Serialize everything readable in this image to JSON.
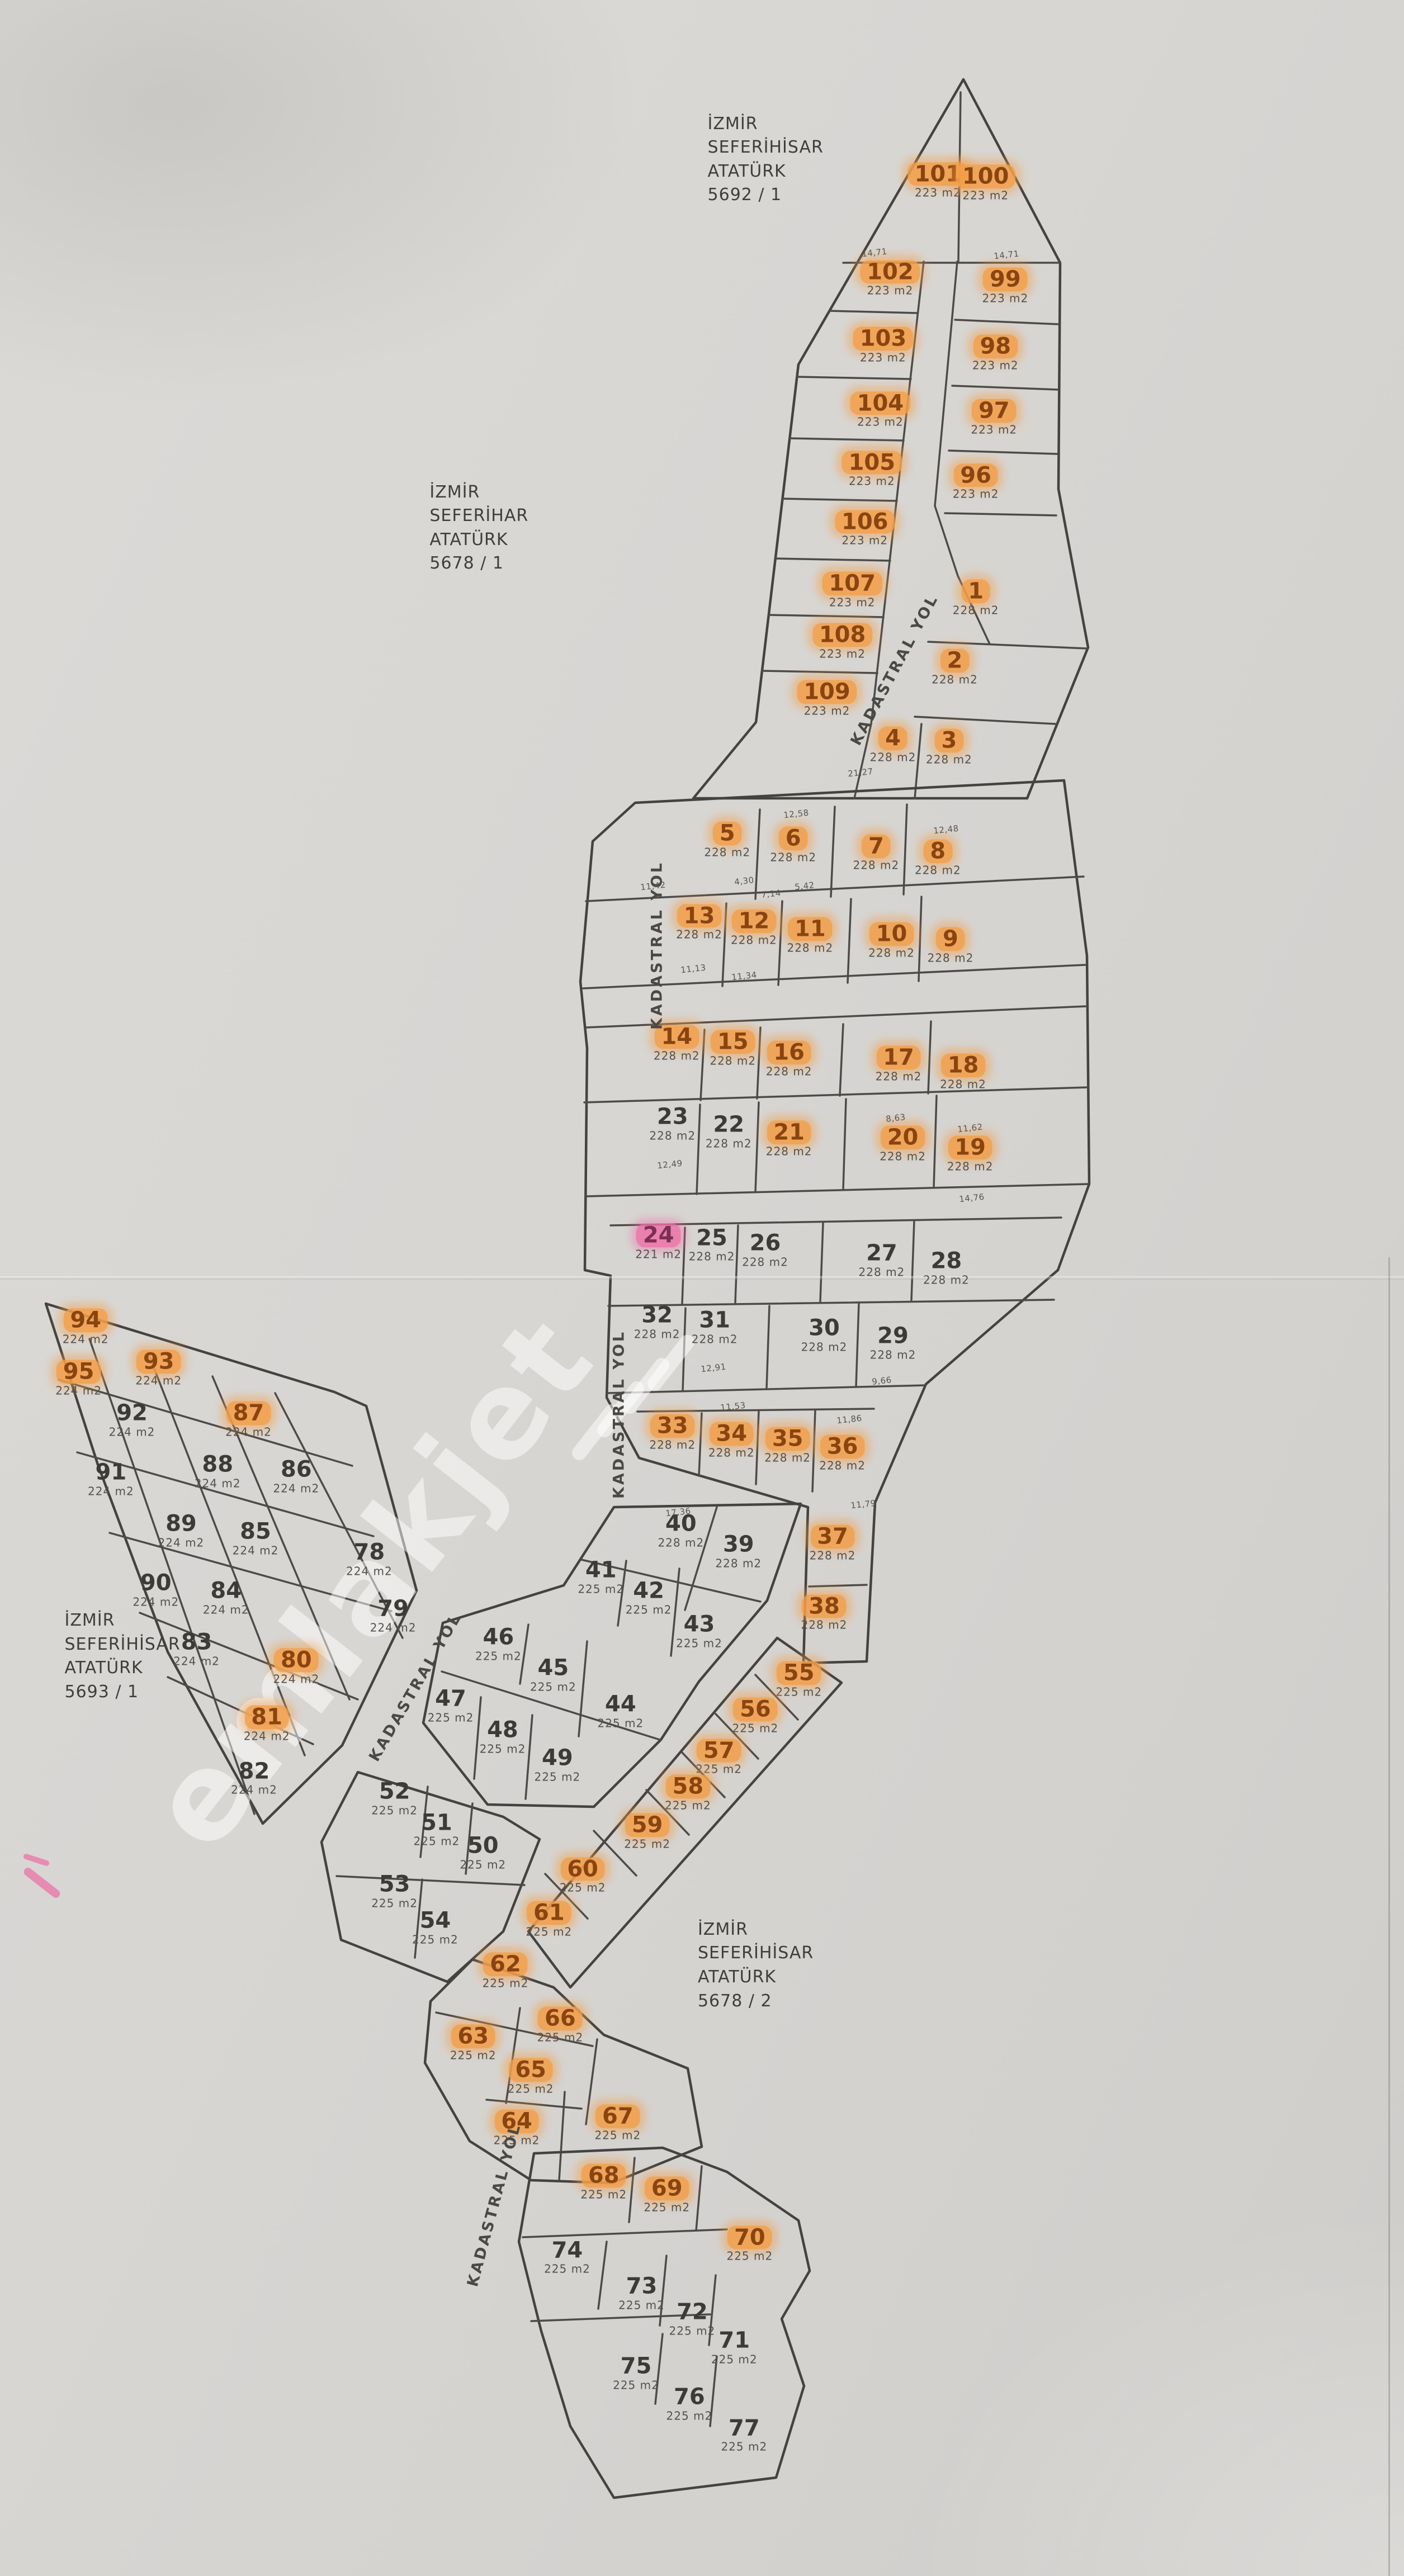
{
  "map": {
    "watermark": {
      "text": "emlakjet"
    },
    "palette": {
      "paper": "#d8d6d3",
      "line": "#454340",
      "highlight_orange": "#f29e48",
      "highlight_pink": "#ee6ca6",
      "number": "#3d3b37",
      "number_hl": "#8a4410",
      "area_text": "#53514c"
    },
    "region_labels": [
      {
        "name": "block-5692-1",
        "text": "İZMİR\nSEFERİHİSAR\nATATÜRK\n5692 / 1",
        "x": 50.4,
        "y": 6.2
      },
      {
        "name": "block-5678-1",
        "text": "İZMİR\nSEFERİHAR\nATATÜRK\n5678 / 1",
        "x": 30.6,
        "y": 20.5
      },
      {
        "name": "block-5693-1",
        "text": "İZMİR\nSEFERİHİSAR\nATATÜRK\n5693 / 1",
        "x": 4.6,
        "y": 64.3
      },
      {
        "name": "block-5678-2",
        "text": "İZMİR\nSEFERİHİSAR\nATATÜRK\n5678 / 2",
        "x": 49.7,
        "y": 76.3
      }
    ],
    "road_labels": [
      {
        "text": "KADASTRAL YOL",
        "x": 63.7,
        "y": 26.0,
        "rot": -62
      },
      {
        "text": "KADASTRAL YOL",
        "x": 46.8,
        "y": 36.7,
        "rot": -90
      },
      {
        "text": "KADASTRAL YOL",
        "x": 44.1,
        "y": 54.9,
        "rot": -90
      },
      {
        "text": "KADASTRAL YOL",
        "x": 29.6,
        "y": 65.5,
        "rot": -60
      },
      {
        "text": "KADASTRAL YOL",
        "x": 35.2,
        "y": 85.6,
        "rot": -75
      }
    ],
    "parcels": [
      {
        "n": "101",
        "a": "223 m2",
        "x": 66.8,
        "y": 7.0,
        "h": "o"
      },
      {
        "n": "100",
        "a": "223 m2",
        "x": 70.2,
        "y": 7.1,
        "h": "o"
      },
      {
        "n": "102",
        "a": "223 m2",
        "x": 63.4,
        "y": 10.8,
        "h": "o"
      },
      {
        "n": "99",
        "a": "223 m2",
        "x": 71.6,
        "y": 11.1,
        "h": "o"
      },
      {
        "n": "103",
        "a": "223 m2",
        "x": 62.9,
        "y": 13.4,
        "h": "o"
      },
      {
        "n": "98",
        "a": "223 m2",
        "x": 70.9,
        "y": 13.7,
        "h": "o"
      },
      {
        "n": "104",
        "a": "223 m2",
        "x": 62.7,
        "y": 15.9,
        "h": "o"
      },
      {
        "n": "97",
        "a": "223 m2",
        "x": 70.8,
        "y": 16.2,
        "h": "o"
      },
      {
        "n": "105",
        "a": "223 m2",
        "x": 62.1,
        "y": 18.2,
        "h": "o"
      },
      {
        "n": "96",
        "a": "223 m2",
        "x": 69.5,
        "y": 18.7,
        "h": "o"
      },
      {
        "n": "106",
        "a": "223 m2",
        "x": 61.6,
        "y": 20.5,
        "h": "o"
      },
      {
        "n": "107",
        "a": "223 m2",
        "x": 60.7,
        "y": 22.9,
        "h": "o"
      },
      {
        "n": "108",
        "a": "223 m2",
        "x": 60.0,
        "y": 24.9,
        "h": "o"
      },
      {
        "n": "109",
        "a": "223 m2",
        "x": 58.9,
        "y": 27.1,
        "h": "o"
      },
      {
        "n": "1",
        "a": "228 m2",
        "x": 69.5,
        "y": 23.2,
        "h": "o"
      },
      {
        "n": "2",
        "a": "228 m2",
        "x": 68.0,
        "y": 25.9,
        "h": "o"
      },
      {
        "n": "3",
        "a": "228 m2",
        "x": 67.6,
        "y": 29.0,
        "h": "o"
      },
      {
        "n": "4",
        "a": "228 m2",
        "x": 63.6,
        "y": 28.9,
        "h": "o"
      },
      {
        "n": "5",
        "a": "228 m2",
        "x": 51.8,
        "y": 32.6,
        "h": "o"
      },
      {
        "n": "6",
        "a": "228 m2",
        "x": 56.5,
        "y": 32.8,
        "h": "o"
      },
      {
        "n": "7",
        "a": "228 m2",
        "x": 62.4,
        "y": 33.1,
        "h": "o"
      },
      {
        "n": "8",
        "a": "228 m2",
        "x": 66.8,
        "y": 33.3,
        "h": "o"
      },
      {
        "n": "9",
        "a": "228 m2",
        "x": 67.7,
        "y": 36.7,
        "h": "o"
      },
      {
        "n": "10",
        "a": "228 m2",
        "x": 63.5,
        "y": 36.5,
        "h": "o"
      },
      {
        "n": "11",
        "a": "228 m2",
        "x": 57.7,
        "y": 36.3,
        "h": "o"
      },
      {
        "n": "12",
        "a": "228 m2",
        "x": 53.7,
        "y": 36.0,
        "h": "o"
      },
      {
        "n": "13",
        "a": "228 m2",
        "x": 49.8,
        "y": 35.8,
        "h": "o"
      },
      {
        "n": "14",
        "a": "228 m2",
        "x": 48.2,
        "y": 40.5,
        "h": "o"
      },
      {
        "n": "15",
        "a": "228 m2",
        "x": 52.2,
        "y": 40.7,
        "h": "o"
      },
      {
        "n": "16",
        "a": "228 m2",
        "x": 56.2,
        "y": 41.1,
        "h": "o"
      },
      {
        "n": "17",
        "a": "228 m2",
        "x": 64.0,
        "y": 41.3,
        "h": "o"
      },
      {
        "n": "18",
        "a": "228 m2",
        "x": 68.6,
        "y": 41.6,
        "h": "o"
      },
      {
        "n": "19",
        "a": "228 m2",
        "x": 69.1,
        "y": 44.8,
        "h": "o"
      },
      {
        "n": "20",
        "a": "228 m2",
        "x": 64.3,
        "y": 44.4,
        "h": "o"
      },
      {
        "n": "21",
        "a": "228 m2",
        "x": 56.2,
        "y": 44.2,
        "h": "o"
      },
      {
        "n": "22",
        "a": "228 m2",
        "x": 51.9,
        "y": 43.9,
        "h": ""
      },
      {
        "n": "23",
        "a": "228 m2",
        "x": 47.9,
        "y": 43.6,
        "h": ""
      },
      {
        "n": "24",
        "a": "221 m2",
        "x": 46.9,
        "y": 48.2,
        "h": "p"
      },
      {
        "n": "25",
        "a": "228 m2",
        "x": 50.7,
        "y": 48.3,
        "h": ""
      },
      {
        "n": "26",
        "a": "228 m2",
        "x": 54.5,
        "y": 48.5,
        "h": ""
      },
      {
        "n": "27",
        "a": "228 m2",
        "x": 62.8,
        "y": 48.9,
        "h": ""
      },
      {
        "n": "28",
        "a": "228 m2",
        "x": 67.4,
        "y": 49.2,
        "h": ""
      },
      {
        "n": "29",
        "a": "228 m2",
        "x": 63.6,
        "y": 52.1,
        "h": ""
      },
      {
        "n": "30",
        "a": "228 m2",
        "x": 58.7,
        "y": 51.8,
        "h": ""
      },
      {
        "n": "31",
        "a": "228 m2",
        "x": 50.9,
        "y": 51.5,
        "h": ""
      },
      {
        "n": "32",
        "a": "228 m2",
        "x": 46.8,
        "y": 51.3,
        "h": ""
      },
      {
        "n": "33",
        "a": "228 m2",
        "x": 47.9,
        "y": 55.6,
        "h": "o"
      },
      {
        "n": "34",
        "a": "228 m2",
        "x": 52.1,
        "y": 55.9,
        "h": "o"
      },
      {
        "n": "35",
        "a": "228 m2",
        "x": 56.1,
        "y": 56.1,
        "h": "o"
      },
      {
        "n": "36",
        "a": "228 m2",
        "x": 60.0,
        "y": 56.4,
        "h": "o"
      },
      {
        "n": "37",
        "a": "228 m2",
        "x": 59.3,
        "y": 59.9,
        "h": "o"
      },
      {
        "n": "38",
        "a": "228 m2",
        "x": 58.7,
        "y": 62.6,
        "h": "o"
      },
      {
        "n": "39",
        "a": "228 m2",
        "x": 52.6,
        "y": 60.2,
        "h": ""
      },
      {
        "n": "40",
        "a": "228 m2",
        "x": 48.5,
        "y": 59.4,
        "h": ""
      },
      {
        "n": "41",
        "a": "225 m2",
        "x": 42.8,
        "y": 61.2,
        "h": ""
      },
      {
        "n": "42",
        "a": "225 m2",
        "x": 46.2,
        "y": 62.0,
        "h": ""
      },
      {
        "n": "43",
        "a": "225 m2",
        "x": 49.8,
        "y": 63.3,
        "h": ""
      },
      {
        "n": "44",
        "a": "225 m2",
        "x": 44.2,
        "y": 66.4,
        "h": ""
      },
      {
        "n": "45",
        "a": "225 m2",
        "x": 39.4,
        "y": 65.0,
        "h": ""
      },
      {
        "n": "46",
        "a": "225 m2",
        "x": 35.5,
        "y": 63.8,
        "h": ""
      },
      {
        "n": "47",
        "a": "225 m2",
        "x": 32.1,
        "y": 66.2,
        "h": ""
      },
      {
        "n": "48",
        "a": "225 m2",
        "x": 35.8,
        "y": 67.4,
        "h": ""
      },
      {
        "n": "49",
        "a": "225 m2",
        "x": 39.7,
        "y": 68.5,
        "h": ""
      },
      {
        "n": "50",
        "a": "225 m2",
        "x": 34.4,
        "y": 71.9,
        "h": ""
      },
      {
        "n": "51",
        "a": "225 m2",
        "x": 31.1,
        "y": 71.0,
        "h": ""
      },
      {
        "n": "52",
        "a": "225 m2",
        "x": 28.1,
        "y": 69.8,
        "h": ""
      },
      {
        "n": "53",
        "a": "225 m2",
        "x": 28.1,
        "y": 73.4,
        "h": ""
      },
      {
        "n": "54",
        "a": "225 m2",
        "x": 31.0,
        "y": 74.8,
        "h": ""
      },
      {
        "n": "55",
        "a": "225 m2",
        "x": 56.9,
        "y": 65.2,
        "h": "o"
      },
      {
        "n": "56",
        "a": "225 m2",
        "x": 53.8,
        "y": 66.6,
        "h": "o"
      },
      {
        "n": "57",
        "a": "225 m2",
        "x": 51.2,
        "y": 68.2,
        "h": "o"
      },
      {
        "n": "58",
        "a": "225 m2",
        "x": 49.0,
        "y": 69.6,
        "h": "o"
      },
      {
        "n": "59",
        "a": "225 m2",
        "x": 46.1,
        "y": 71.1,
        "h": "o"
      },
      {
        "n": "60",
        "a": "225 m2",
        "x": 41.5,
        "y": 72.8,
        "h": "o"
      },
      {
        "n": "61",
        "a": "225 m2",
        "x": 39.1,
        "y": 74.5,
        "h": "o"
      },
      {
        "n": "62",
        "a": "225 m2",
        "x": 36.0,
        "y": 76.5,
        "h": "o"
      },
      {
        "n": "63",
        "a": "225 m2",
        "x": 33.7,
        "y": 79.3,
        "h": "o"
      },
      {
        "n": "64",
        "a": "225 m2",
        "x": 36.8,
        "y": 82.6,
        "h": "o"
      },
      {
        "n": "65",
        "a": "225 m2",
        "x": 37.8,
        "y": 80.6,
        "h": "o"
      },
      {
        "n": "66",
        "a": "225 m2",
        "x": 39.9,
        "y": 78.6,
        "h": "o"
      },
      {
        "n": "67",
        "a": "225 m2",
        "x": 44.0,
        "y": 82.4,
        "h": "o"
      },
      {
        "n": "68",
        "a": "225 m2",
        "x": 43.0,
        "y": 84.7,
        "h": "o"
      },
      {
        "n": "69",
        "a": "225 m2",
        "x": 47.5,
        "y": 85.2,
        "h": "o"
      },
      {
        "n": "70",
        "a": "225 m2",
        "x": 53.4,
        "y": 87.1,
        "h": "o"
      },
      {
        "n": "71",
        "a": "225 m2",
        "x": 52.3,
        "y": 91.1,
        "h": ""
      },
      {
        "n": "72",
        "a": "225 m2",
        "x": 49.3,
        "y": 90.0,
        "h": ""
      },
      {
        "n": "73",
        "a": "225 m2",
        "x": 45.7,
        "y": 89.0,
        "h": ""
      },
      {
        "n": "74",
        "a": "225 m2",
        "x": 40.4,
        "y": 87.6,
        "h": ""
      },
      {
        "n": "75",
        "a": "225 m2",
        "x": 45.3,
        "y": 92.1,
        "h": ""
      },
      {
        "n": "76",
        "a": "225 m2",
        "x": 49.1,
        "y": 93.3,
        "h": ""
      },
      {
        "n": "77",
        "a": "225 m2",
        "x": 53.0,
        "y": 94.5,
        "h": ""
      },
      {
        "n": "78",
        "a": "224 m2",
        "x": 26.3,
        "y": 60.5,
        "h": ""
      },
      {
        "n": "79",
        "a": "224 m2",
        "x": 28.0,
        "y": 62.7,
        "h": ""
      },
      {
        "n": "80",
        "a": "224 m2",
        "x": 21.1,
        "y": 64.7,
        "h": "o"
      },
      {
        "n": "81",
        "a": "224 m2",
        "x": 19.0,
        "y": 66.9,
        "h": "o"
      },
      {
        "n": "82",
        "a": "224 m2",
        "x": 18.1,
        "y": 69.0,
        "h": ""
      },
      {
        "n": "83",
        "a": "224 m2",
        "x": 14.0,
        "y": 64.0,
        "h": ""
      },
      {
        "n": "84",
        "a": "224 m2",
        "x": 16.1,
        "y": 62.0,
        "h": ""
      },
      {
        "n": "85",
        "a": "224 m2",
        "x": 18.2,
        "y": 59.7,
        "h": ""
      },
      {
        "n": "86",
        "a": "224 m2",
        "x": 21.1,
        "y": 57.3,
        "h": ""
      },
      {
        "n": "87",
        "a": "224 m2",
        "x": 17.7,
        "y": 55.1,
        "h": "o"
      },
      {
        "n": "88",
        "a": "224 m2",
        "x": 15.5,
        "y": 57.1,
        "h": ""
      },
      {
        "n": "89",
        "a": "224 m2",
        "x": 12.9,
        "y": 59.4,
        "h": ""
      },
      {
        "n": "90",
        "a": "224 m2",
        "x": 11.1,
        "y": 61.7,
        "h": ""
      },
      {
        "n": "91",
        "a": "224 m2",
        "x": 7.9,
        "y": 57.4,
        "h": ""
      },
      {
        "n": "92",
        "a": "224 m2",
        "x": 9.4,
        "y": 55.1,
        "h": ""
      },
      {
        "n": "93",
        "a": "224 m2",
        "x": 11.3,
        "y": 53.1,
        "h": "o"
      },
      {
        "n": "94",
        "a": "224 m2",
        "x": 6.1,
        "y": 51.5,
        "h": "o"
      },
      {
        "n": "95",
        "a": "224 m2",
        "x": 5.6,
        "y": 53.5,
        "h": "o"
      }
    ],
    "dimension_labels": [
      {
        "t": "14,71",
        "x": 62.3,
        "y": 9.8
      },
      {
        "t": "14,71",
        "x": 71.7,
        "y": 9.9
      },
      {
        "t": "21,27",
        "x": 61.3,
        "y": 30.0
      },
      {
        "t": "12,58",
        "x": 56.7,
        "y": 31.6
      },
      {
        "t": "11,42",
        "x": 46.5,
        "y": 34.4
      },
      {
        "t": "11,13",
        "x": 49.4,
        "y": 37.6
      },
      {
        "t": "11,34",
        "x": 53.0,
        "y": 37.9
      },
      {
        "t": "4,30",
        "x": 53.0,
        "y": 34.2
      },
      {
        "t": "7,14",
        "x": 54.9,
        "y": 34.7
      },
      {
        "t": "5,42",
        "x": 57.3,
        "y": 34.4
      },
      {
        "t": "12,48",
        "x": 67.4,
        "y": 32.2
      },
      {
        "t": "8,63",
        "x": 63.8,
        "y": 43.4
      },
      {
        "t": "11,62",
        "x": 69.1,
        "y": 43.8
      },
      {
        "t": "14,76",
        "x": 69.2,
        "y": 46.5
      },
      {
        "t": "12,49",
        "x": 47.7,
        "y": 45.2
      },
      {
        "t": "11,53",
        "x": 52.2,
        "y": 54.6
      },
      {
        "t": "11,86",
        "x": 60.5,
        "y": 55.1
      },
      {
        "t": "17,36",
        "x": 48.3,
        "y": 58.7
      },
      {
        "t": "11,79",
        "x": 61.5,
        "y": 58.4
      },
      {
        "t": "12,91",
        "x": 50.8,
        "y": 53.1
      },
      {
        "t": "9,66",
        "x": 62.8,
        "y": 53.6
      }
    ]
  }
}
